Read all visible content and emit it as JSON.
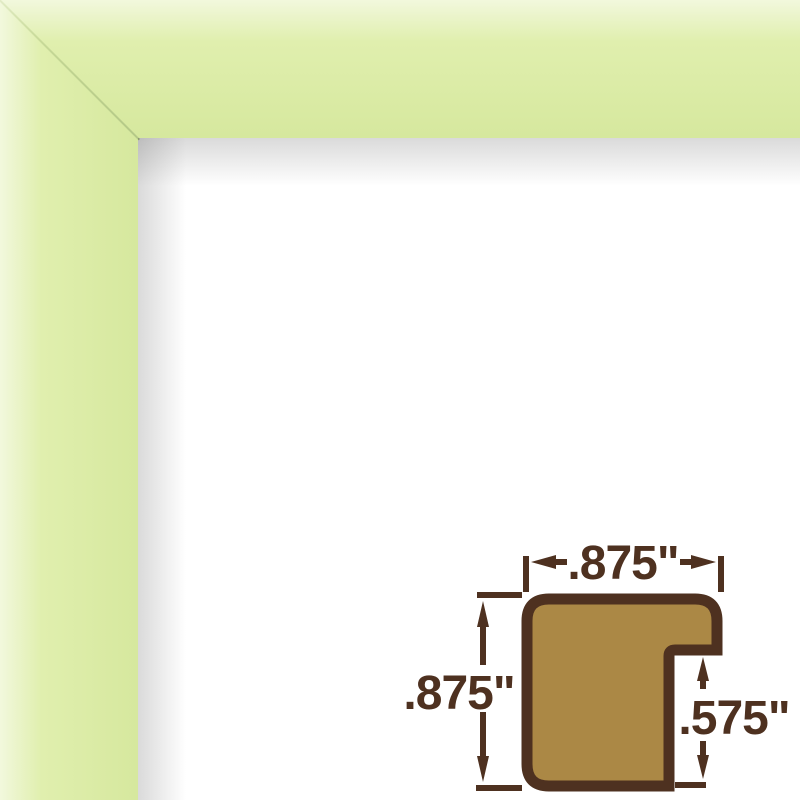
{
  "image": {
    "description": "Pale green picture frame corner sample with white backing and frame moulding cross-section dimension diagram"
  },
  "colors": {
    "frame_green": "#e0efae",
    "frame_green_light": "#f2f8dd",
    "frame_green_deep": "#d6e89e",
    "miter_line": "#b4c887",
    "wood_fill": "#ab8845",
    "outline_brown": "#4e3120",
    "backing_white": "#ffffff"
  },
  "diagram": {
    "labels": {
      "top_width": ".875\"",
      "left_height": ".875\"",
      "rabbet_depth": ".575\""
    }
  }
}
